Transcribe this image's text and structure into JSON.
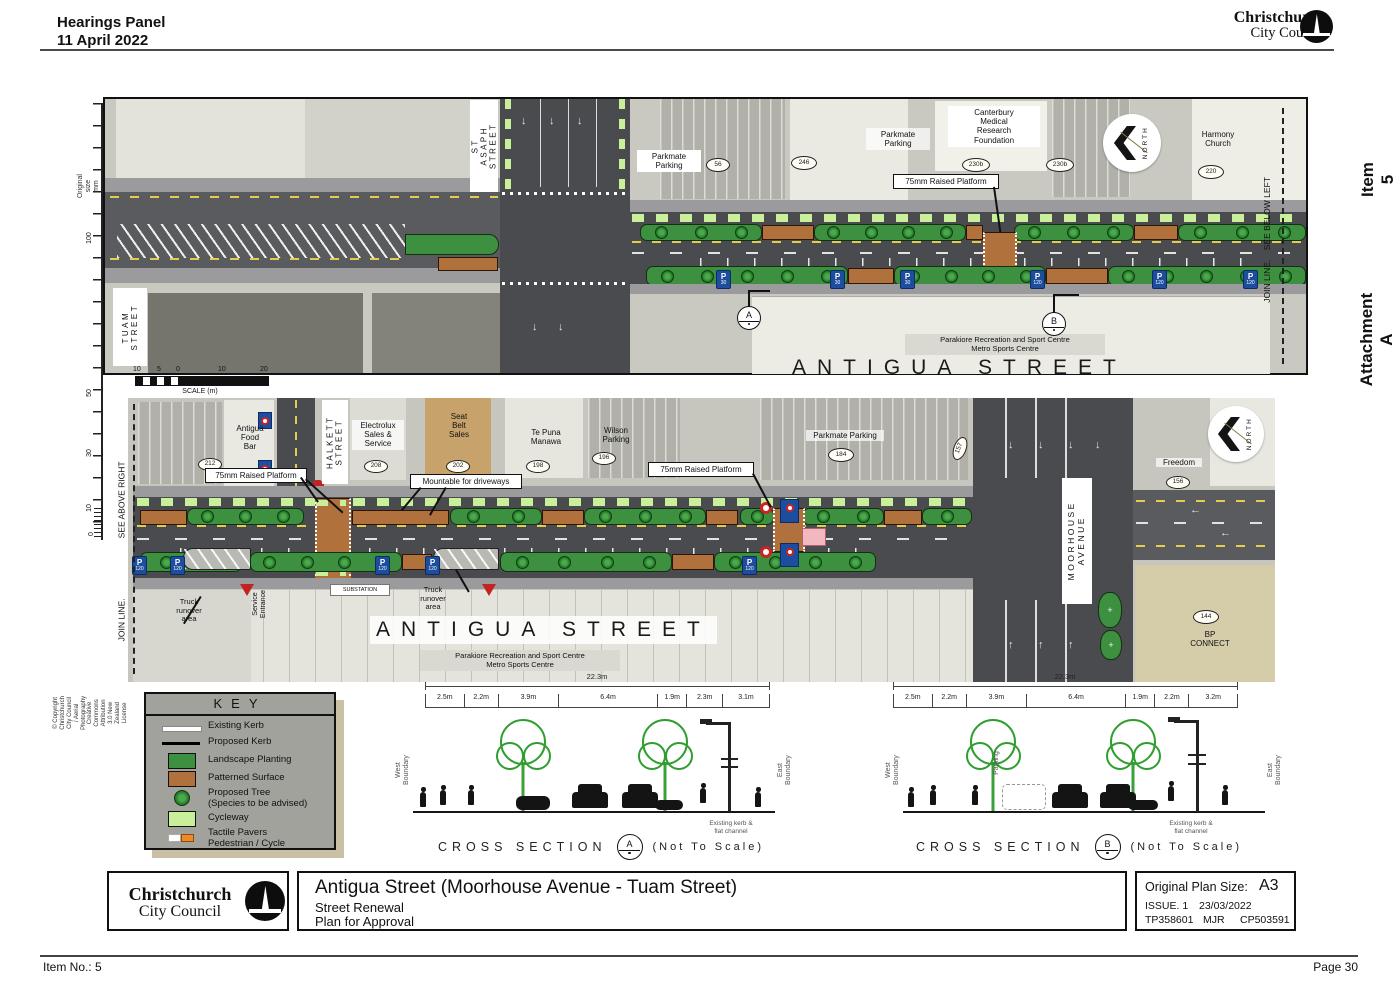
{
  "header": {
    "panel_title": "Hearings Panel",
    "date": "11 April 2022",
    "logo_top": "Christchurch",
    "logo_bottom": "City Council"
  },
  "margin_right": {
    "item": "Item 5",
    "attachment": "Attachment A"
  },
  "margin_left": {
    "ruler_title": "Original size mm",
    "ruler_marks": [
      "100",
      "50",
      "30",
      "10",
      "0"
    ],
    "copyright": "© Copyright Christchurch City Council / Aerial Photography Creative Commons Attribution 3.0 New Zealand License"
  },
  "footer": {
    "item_no": "Item No.: 5",
    "page": "Page 30"
  },
  "icons": {
    "arrow_down": "↓",
    "arrow_up": "↑",
    "arrow_left": "←",
    "plus": "+"
  },
  "colors": {
    "landscape_planting": "#3c9040",
    "patterned_surface": "#b0713c",
    "cycleway": "#c9ef9b",
    "existing_kerb": "#ffffff",
    "proposed_kerb": "#000000",
    "tactile_orange": "#f08a24",
    "parking_sign_blue": "#1d4e9e",
    "stop_sign_red": "#c22222"
  },
  "plan_top": {
    "street_big": "ANTIGUA STREET",
    "tuam": "TUAM\nSTREET",
    "st_asaph": "ST ASAPH\nSTREET",
    "parkmate1": "Parkmate\nParking",
    "parkmate2": "Parkmate\nParking",
    "canterbury": "Canterbury\nMedical\nResearch\nFoundation",
    "harmony": "Harmony\nChurch",
    "raised_platform": "75mm Raised Platform",
    "parakiore": "Parakiore Recreation and Sport Centre\nMetro Sports Centre",
    "join_line": "JOIN LINE.    SEE BELOW LEFT",
    "north": "NORTH",
    "marker_a": "A",
    "marker_b": "B",
    "badges": {
      "b56": "56",
      "b246": "246",
      "b230a": "230b",
      "b230b": "230b",
      "b220": "220"
    },
    "p_signs": [
      {
        "p": "P",
        "n": "30"
      },
      {
        "p": "P",
        "n": "30"
      },
      {
        "p": "P",
        "n": "30"
      },
      {
        "p": "P",
        "n": "120"
      },
      {
        "p": "P",
        "n": "120"
      },
      {
        "p": "P",
        "n": "120"
      }
    ]
  },
  "scale_bar": {
    "ticks": [
      "10",
      "5",
      "0",
      "10",
      "20"
    ],
    "caption": "SCALE (m)"
  },
  "plan_bottom": {
    "street_big": "ANTIGUA STREET",
    "halkett": "HALKETT\nSTREET",
    "moorhouse": "MOORHOUSE\nAVENUE",
    "see_above": "SEE ABOVE RIGHT",
    "join_line": "JOIN LINE.",
    "north": "NORTH",
    "antigua_food": "Antigua\nFood\nBar",
    "electrolux": "Electrolux\nSales &\nService",
    "seat_belt": "Seat\nBelt\nSales",
    "te_puna": "Te Puna\nManawa",
    "wilson": "Wilson\nParking",
    "parkmate": "Parkmate Parking",
    "freedom": "Freedom",
    "bp": "BP\nCONNECT",
    "raised_platform_left": "75mm Raised Platform",
    "raised_platform_right": "75mm Raised Platform",
    "mountable": "Mountable for driveways",
    "truck1": "Truck\nrunover\narea",
    "truck2": "Truck\nrunover\narea",
    "service_entrance": "Service\nEntrance",
    "substation": "SUBSTATION",
    "parakiore": "Parakiore Recreation and Sport Centre\nMetro Sports Centre",
    "badges": {
      "b212": "212",
      "b208": "208",
      "b202": "202",
      "b198": "198",
      "b196": "196",
      "b184": "184",
      "b157": "157",
      "b156": "156",
      "b144": "144"
    },
    "p_signs": [
      {
        "p": "P",
        "n": "120"
      },
      {
        "p": "P",
        "n": "120"
      },
      {
        "p": "P",
        "n": "120"
      },
      {
        "p": "P",
        "n": "120"
      },
      {
        "p": "P",
        "n": "120"
      }
    ]
  },
  "key": {
    "title": "KEY",
    "items": [
      {
        "label": "Existing Kerb"
      },
      {
        "label": "Proposed Kerb"
      },
      {
        "label": "Landscape Planting"
      },
      {
        "label": "Patterned Surface"
      },
      {
        "label": "Proposed Tree\n(Species to be advised)"
      },
      {
        "label": "Cycleway"
      },
      {
        "label": "Tactile Pavers\nPedestrian / Cycle"
      }
    ]
  },
  "sections": {
    "a": {
      "total": "22.3m",
      "segments": [
        "2.5m",
        "2.2m",
        "3.9m",
        "6.4m",
        "1.9m",
        "2.3m",
        "3.1m"
      ],
      "west": "West Boundary",
      "east": "East Boundary",
      "kerb_note": "Existing kerb &\nflat channel",
      "caption": "CROSS SECTION",
      "marker": "A",
      "nts": "(Not To Scale)"
    },
    "b": {
      "total": "22.3m",
      "segments": [
        "2.5m",
        "2.2m",
        "3.9m",
        "6.4m",
        "1.9m",
        "2.2m",
        "3.2m"
      ],
      "west": "West Boundary",
      "east": "East Boundary",
      "parking": "Parking",
      "kerb_note": "Existing kerb &\nflat channel",
      "caption": "CROSS SECTION",
      "marker": "B",
      "nts": "(Not To Scale)"
    }
  },
  "title_block": {
    "logo_top": "Christchurch",
    "logo_bottom": "City Council",
    "title": "Antigua Street (Moorhouse Avenue - Tuam Street)",
    "sub1": "Street Renewal",
    "sub2": "Plan for Approval",
    "plan_size_label": "Original Plan Size:",
    "plan_size": "A3",
    "issue": "ISSUE. 1",
    "issue_date": "23/03/2022",
    "tp": "TP358601",
    "initials": "MJR",
    "cp": "CP503591"
  }
}
